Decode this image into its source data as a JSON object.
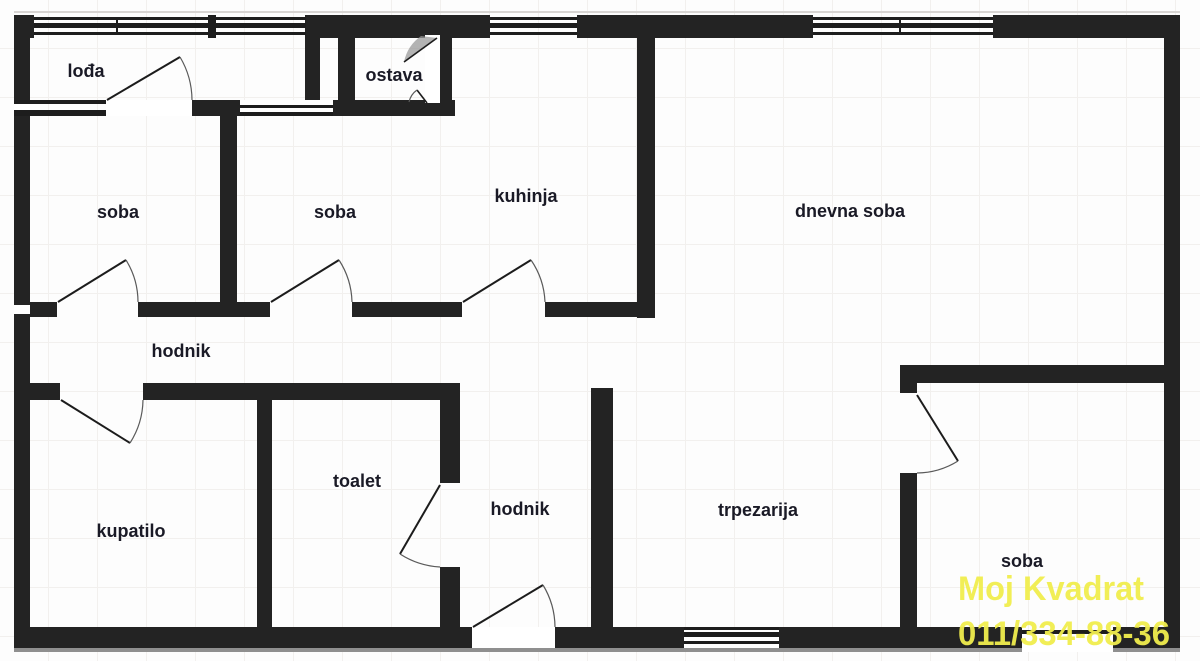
{
  "plan": {
    "type": "apartment-floor-plan",
    "rooms": {
      "loggia": {
        "label": "lođa"
      },
      "storage": {
        "label": "ostava"
      },
      "bedroom1": {
        "label": "soba"
      },
      "bedroom2": {
        "label": "soba"
      },
      "kitchen": {
        "label": "kuhinja"
      },
      "living_room": {
        "label": "dnevna soba"
      },
      "hallway_upper": {
        "label": "hodnik"
      },
      "bathroom": {
        "label": "kupatilo"
      },
      "toilet": {
        "label": "toalet"
      },
      "hallway_lower": {
        "label": "hodnik"
      },
      "dining_room": {
        "label": "trpezarija"
      },
      "bedroom3": {
        "label": "soba"
      }
    }
  },
  "watermark": {
    "line1": "Moj Kvadrat",
    "line2": "011/334-88-36"
  },
  "colors": {
    "wall": "#232323",
    "label": "#1a1a26",
    "watermark": "#f1ee4e",
    "grid": "#f2f0ee",
    "background": "#fdfdfd",
    "arc": "#5a5a5a",
    "leaf": "#1c1c1c",
    "shadow": "#8f8f8f"
  }
}
